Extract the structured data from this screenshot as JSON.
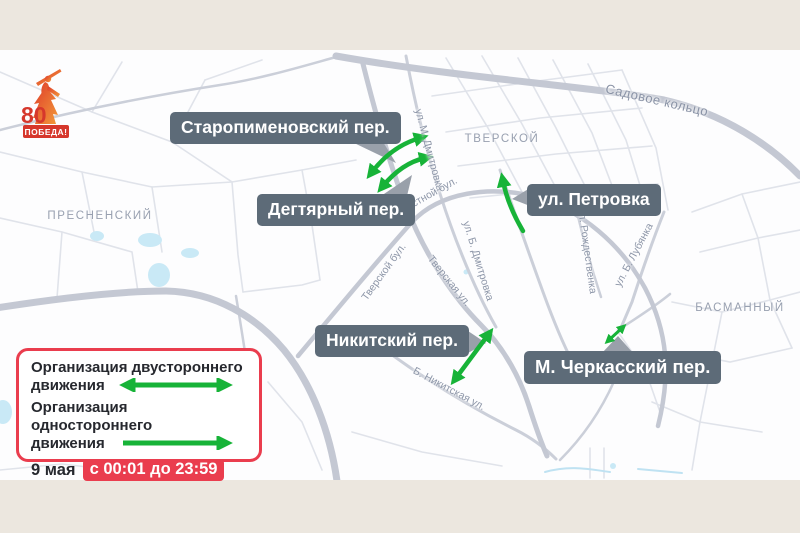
{
  "logo": {
    "number": "80",
    "text": "ПОБЕДА!"
  },
  "map": {
    "districts": [
      {
        "name": "ПРЕСНЕНСКИЙ"
      },
      {
        "name": "ТВЕРСКОЙ"
      },
      {
        "name": "БАСМАННЫЙ"
      }
    ],
    "streets": [
      {
        "name": "ул. М. Дмитровка"
      },
      {
        "name": "Садовое кольцо"
      },
      {
        "name": "Страстной бул."
      },
      {
        "name": "ул. Б. Дмитровка"
      },
      {
        "name": "Тверской бул."
      },
      {
        "name": "Тверская ул."
      },
      {
        "name": "Б. Никитская ул."
      },
      {
        "name": "ул. Рождественка"
      },
      {
        "name": "ул. Б. Лубянка"
      }
    ],
    "callouts": [
      {
        "label": "Старопименовский пер."
      },
      {
        "label": "Дегтярный пер."
      },
      {
        "label": "ул. Петровка"
      },
      {
        "label": "Никитский пер."
      },
      {
        "label": "М. Черкасский пер."
      }
    ]
  },
  "legend": {
    "two_way_line1": "Организация двустороннего",
    "two_way_line2": "движения",
    "one_way_line1": "Организация одностороннего",
    "one_way_line2": "движения",
    "date": "9 мая",
    "time": "с 00:01 до 23:59"
  },
  "colors": {
    "arrow_green": "#17b338",
    "accent_red": "#ea3d4e",
    "callout_bg": "#5d6b78",
    "banner_cream": "#ece7df",
    "road_gray": "#c9cdd7",
    "water_blue": "#c9e9f6"
  }
}
